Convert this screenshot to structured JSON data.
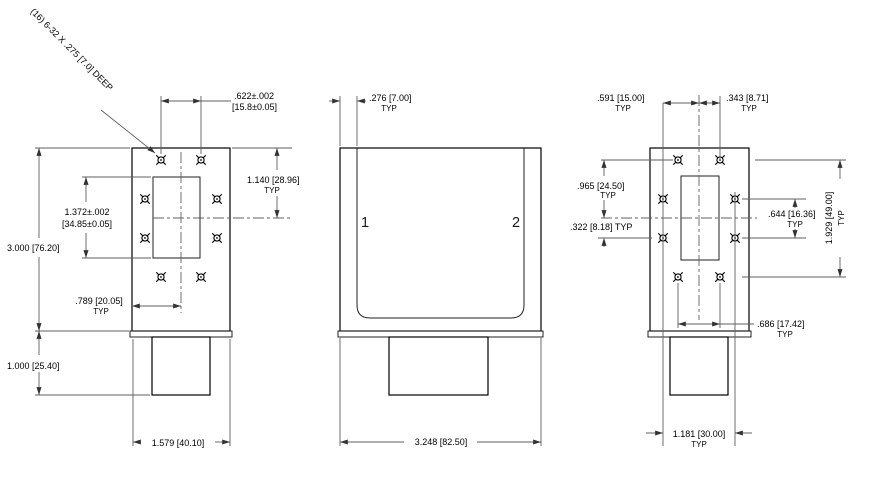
{
  "annotations": {
    "typ": "TYP",
    "hole_note": "(16) 6-32 X .275 [7.0] DEEP"
  },
  "left_view": {
    "dims": {
      "top_hole_spacing_in": ".622±.002",
      "top_hole_spacing_mm": "[15.8±0.05]",
      "top_edge_to_centerline": "1.140 [28.96]",
      "aperture_height_in": "1.372±.002",
      "aperture_height_mm": "[34.85±0.05]",
      "overall_height": "3.000 [76.20]",
      "edge_to_centerline": ".789 [20.05]",
      "connector_depth": "1.000 [25.40]",
      "overall_width": "1.579 [40.10]"
    }
  },
  "front_view": {
    "port_labels": [
      "1",
      "2"
    ],
    "dims": {
      "wall_thickness": ".276 [7.00]",
      "overall_width": "3.248 [82.50]"
    }
  },
  "right_view": {
    "dims": {
      "centerline_to_left_holes": ".591 [15.00]",
      "centerline_to_right_holes": ".343 [8.71]",
      "top_holes_to_centerline": ".965 [24.50]",
      "centerline_to_mid_holes": ".322 [8.18] TYP",
      "mid_hole_spacing": ".644 [16.36]",
      "hole_pattern_height": "1.929 [49.00]",
      "bottom_hole_spacing": ".686 [17.42]",
      "hole_column_spacing": "1.181 [30.00]"
    }
  }
}
